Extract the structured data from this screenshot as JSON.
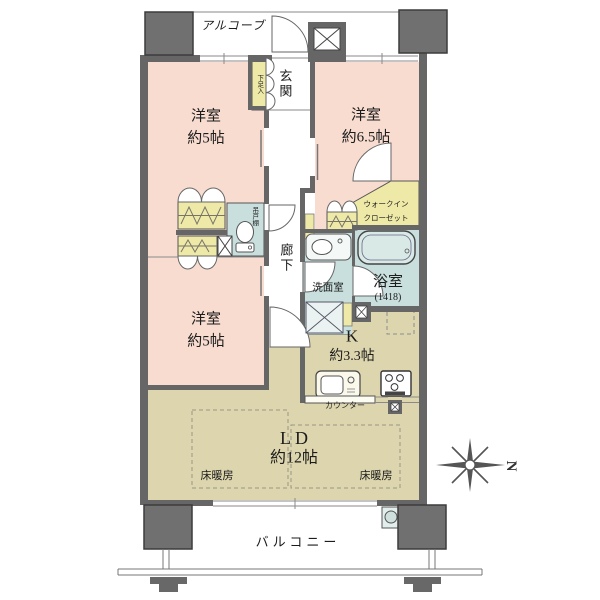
{
  "page": {
    "type": "apartment-floor-plan"
  },
  "labels": {
    "alcove": "アルコーブ",
    "entrance": "玄関",
    "shoe_cabinet": "下足入",
    "hanging_cupboard": "吊戸棚",
    "corridor": "廊下",
    "washroom": "洗面室",
    "bathroom": "浴室",
    "bathroom_size": "(1418)",
    "walk_in_closet_line1": "ウォークイン",
    "walk_in_closet_line2": "クローゼット",
    "kitchen": "K",
    "kitchen_size": "約3.3帖",
    "counter": "カウンター",
    "living_dining": "LD",
    "living_dining_size": "約12帖",
    "floor_heating": "床暖房",
    "balcony": "バルコニー",
    "compass_north": "N"
  },
  "rooms": [
    {
      "name": "洋室",
      "size": "約5帖"
    },
    {
      "name": "洋室",
      "size": "約6.5帖"
    },
    {
      "name": "洋室",
      "size": "約5帖"
    }
  ],
  "colors": {
    "room_pink": "#f8dcd0",
    "wood_tan": "#dcd5ae",
    "closet_yellow": "#efe9a8",
    "wet_area_blue": "#c9dfdd",
    "wall_gray": "#666666",
    "pillar_gray": "#707070"
  }
}
